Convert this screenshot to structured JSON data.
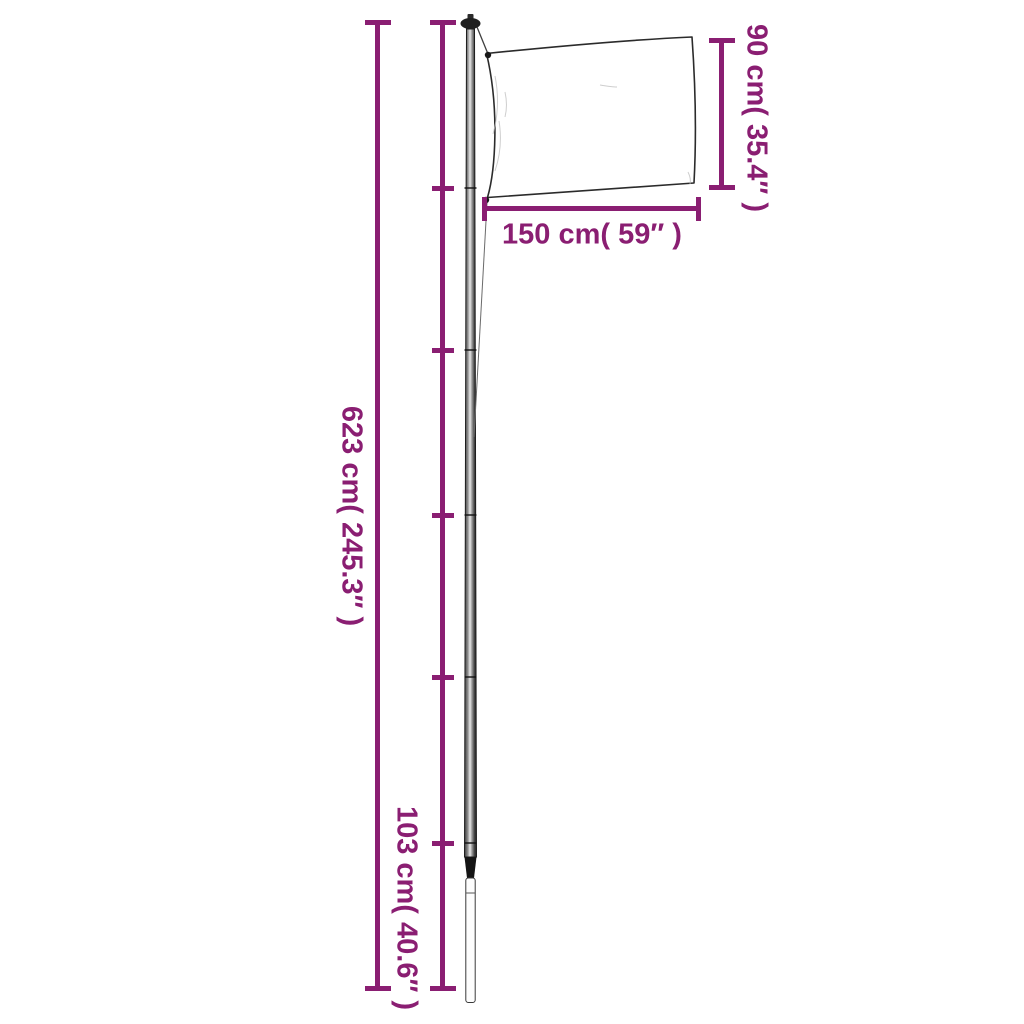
{
  "page": {
    "background": "#ffffff",
    "width": 1024,
    "height": 1024
  },
  "colors": {
    "accent": "#8A1E72",
    "pole_dark": "#2b2b2b",
    "flag_outline": "#2b2b2b",
    "flag_fill": "#ffffff",
    "ground_sleeve_fill": "#fdfdfd"
  },
  "figure": {
    "type": "product-dimension-diagram",
    "subject": "telescopic flagpole with flag",
    "pole_section_ticks": 5,
    "pole_sections": 6
  },
  "dimensions": [
    {
      "name": "total_height",
      "cm": 623,
      "inches": 245.3,
      "label": "623 cm( 245.3″ )"
    },
    {
      "name": "bottom_section_height",
      "cm": 103,
      "inches": 40.6,
      "label": "103 cm( 40.6″ )"
    },
    {
      "name": "flag_height",
      "cm": 90,
      "inches": 35.4,
      "label": "90 cm( 35.4″ )"
    },
    {
      "name": "flag_width",
      "cm": 150,
      "inches": 59,
      "label": "150 cm( 59″ )"
    }
  ]
}
